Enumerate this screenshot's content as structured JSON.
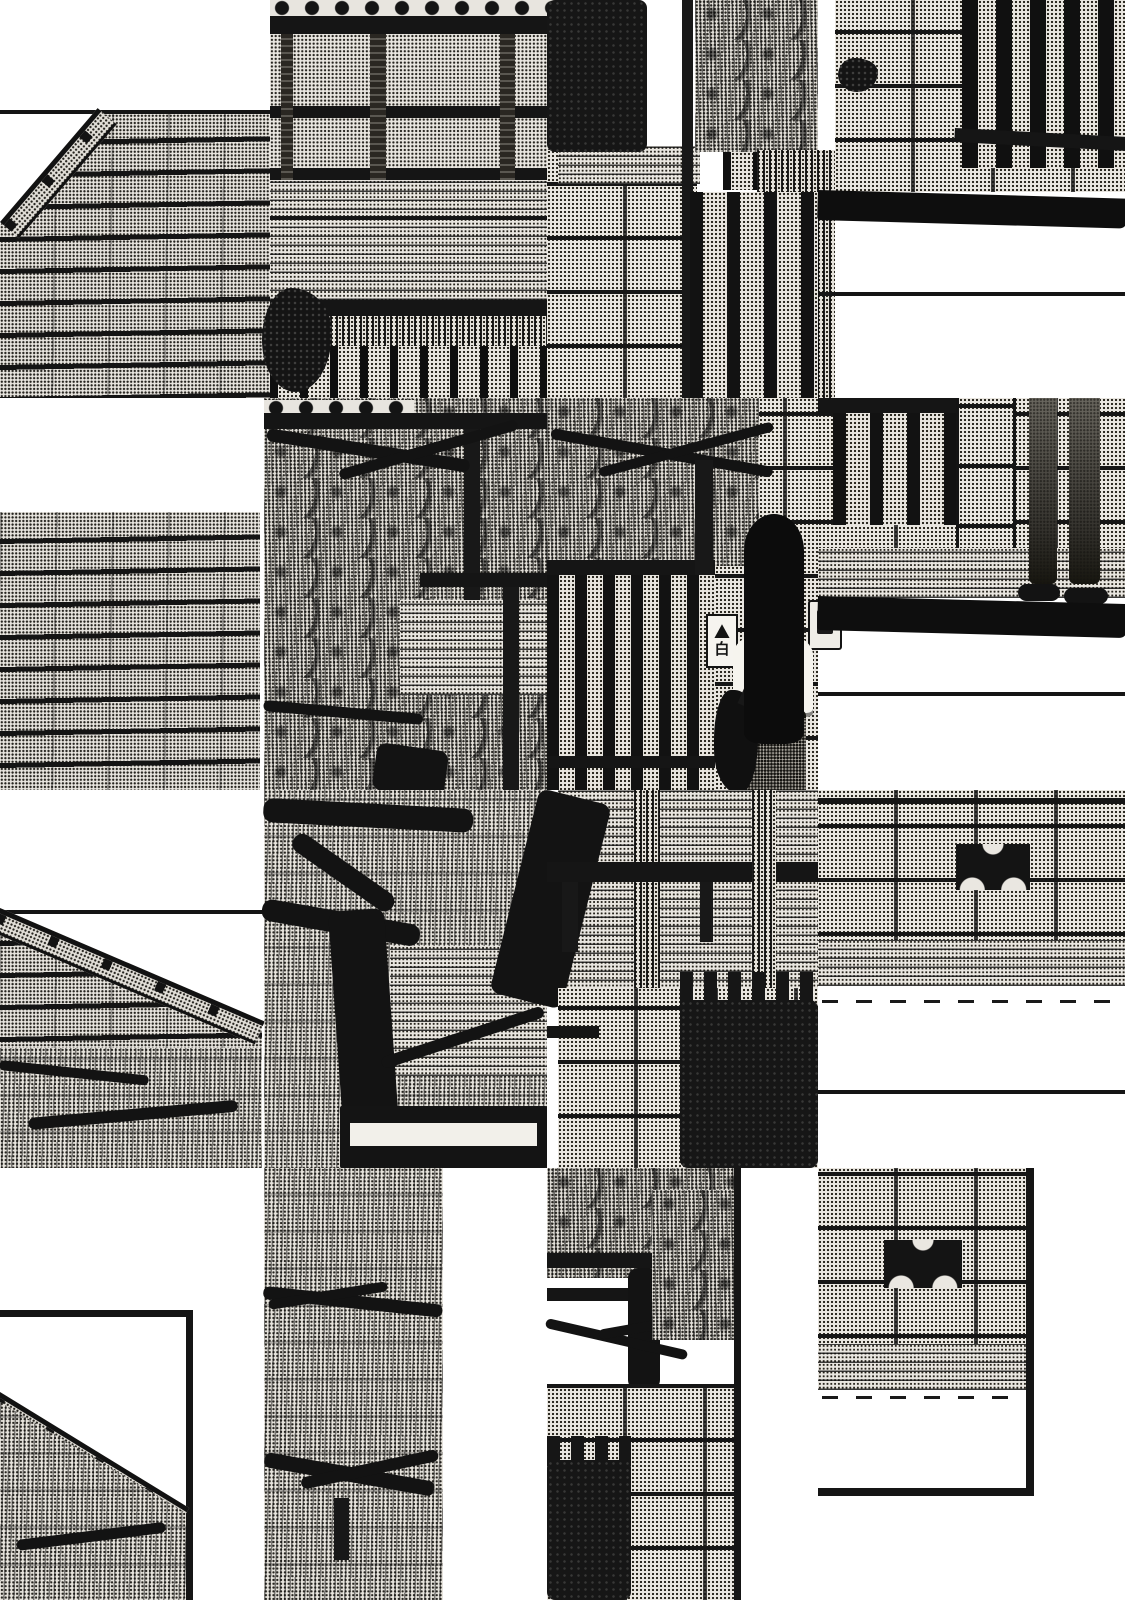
{
  "page": {
    "description": "Black-and-white manga page rendered as an offset tile collage: traditional Japanese house with wavy roof tiles, pine trees, stone walls, slatted gates, a long-haired girl in a striped shirt facing a gate nameplate, and a pedestrian's legs on the street.",
    "palette": {
      "paper": "#ffffff",
      "ink": "#141414",
      "tone": "#e8e5df"
    }
  },
  "nameplate": {
    "text": "白"
  },
  "tiles": [
    {
      "name": "panel-top-edge-line",
      "type": "line",
      "x": 0,
      "y": 110,
      "w": 390,
      "h": 4
    },
    {
      "name": "roof-tiles-top-left",
      "type": "rooftiles",
      "x": 0,
      "y": 114,
      "w": 270,
      "h": 284,
      "cls": "clip-a"
    },
    {
      "name": "roof-ridge-top-left",
      "type": "ridge",
      "x": 0,
      "y": 222,
      "w": 150,
      "h": 20,
      "rot": -49.4
    },
    {
      "name": "wood-house-wall",
      "type": "tone",
      "x": 270,
      "y": 0,
      "w": 290,
      "h": 398
    },
    {
      "name": "eave-tile-ends-row",
      "type": "circlerow",
      "x": 270,
      "y": 0,
      "w": 290,
      "h": 16
    },
    {
      "name": "eave-beam",
      "type": "line",
      "x": 270,
      "y": 16,
      "w": 290,
      "h": 18
    },
    {
      "name": "wall-beam-1",
      "type": "line",
      "x": 270,
      "y": 106,
      "w": 290,
      "h": 12
    },
    {
      "name": "wall-beam-2",
      "type": "line",
      "x": 270,
      "y": 168,
      "w": 290,
      "h": 12
    },
    {
      "name": "wall-post-1",
      "type": "woodpost",
      "x": 281,
      "y": 34,
      "w": 12,
      "h": 146
    },
    {
      "name": "wall-post-2",
      "type": "woodpost",
      "x": 370,
      "y": 34,
      "w": 16,
      "h": 146
    },
    {
      "name": "wall-post-3",
      "type": "woodpost",
      "x": 500,
      "y": 34,
      "w": 15,
      "h": 146
    },
    {
      "name": "veranda-planks",
      "type": "planks",
      "x": 270,
      "y": 180,
      "w": 290,
      "h": 120
    },
    {
      "name": "veranda-edge-line",
      "type": "line",
      "x": 270,
      "y": 216,
      "w": 290,
      "h": 4
    },
    {
      "name": "base-beam",
      "type": "line",
      "x": 270,
      "y": 300,
      "w": 290,
      "h": 16
    },
    {
      "name": "under-fringe",
      "type": "fringe",
      "x": 270,
      "y": 316,
      "w": 290,
      "h": 30
    },
    {
      "name": "lattice-fence",
      "type": "slats",
      "x": 270,
      "y": 346,
      "w": 290,
      "h": 52
    },
    {
      "name": "garden-shrub",
      "type": "pineclump",
      "x": 262,
      "y": 288,
      "w": 70,
      "h": 104
    },
    {
      "name": "stone-gate-wall",
      "type": "stonewall",
      "x": 547,
      "y": 150,
      "w": 150,
      "h": 248
    },
    {
      "name": "stone-lintel",
      "type": "planks",
      "x": 558,
      "y": 146,
      "w": 142,
      "h": 38
    },
    {
      "name": "dark-hedge-top",
      "type": "darkbush",
      "x": 547,
      "y": 0,
      "w": 100,
      "h": 152
    },
    {
      "name": "gate-post-dark",
      "type": "darkpost",
      "x": 682,
      "y": 0,
      "w": 11,
      "h": 398
    },
    {
      "name": "slatted-door",
      "type": "slats",
      "x": 723,
      "y": 0,
      "w": 40,
      "h": 190
    },
    {
      "name": "pine-tuft-top",
      "type": "pine",
      "x": 695,
      "y": 0,
      "w": 123,
      "h": 152
    },
    {
      "name": "hanging-needles",
      "type": "fringe",
      "x": 757,
      "y": 150,
      "w": 78,
      "h": 248
    },
    {
      "name": "inner-fence-bars",
      "type": "fencebars",
      "x": 690,
      "y": 192,
      "w": 128,
      "h": 206
    },
    {
      "name": "street-wall-top-right",
      "type": "stonewall",
      "x": 835,
      "y": 0,
      "w": 290,
      "h": 192
    },
    {
      "name": "wall-ornament-dark",
      "type": "pineclump",
      "x": 838,
      "y": 58,
      "w": 40,
      "h": 34
    },
    {
      "name": "iron-gate-bars",
      "type": "fencedark",
      "x": 962,
      "y": 0,
      "w": 163,
      "h": 168
    },
    {
      "name": "iron-gate-rail",
      "type": "line",
      "x": 955,
      "y": 128,
      "w": 172,
      "h": 14,
      "rot": 3
    },
    {
      "name": "road-shadow-band",
      "type": "shadow",
      "x": 818,
      "y": 190,
      "w": 310,
      "h": 30,
      "rot": 1.6
    },
    {
      "name": "road-line-1",
      "type": "line",
      "x": 818,
      "y": 292,
      "w": 307,
      "h": 4
    },
    {
      "name": "roof-tiles-left",
      "type": "rooftiles",
      "x": 0,
      "y": 512,
      "w": 260,
      "h": 278
    },
    {
      "name": "pine-tile-base",
      "type": "pine",
      "x": 264,
      "y": 398,
      "w": 283,
      "h": 392
    },
    {
      "name": "eave-ends-row-2",
      "type": "circlerow",
      "x": 264,
      "y": 400,
      "w": 150,
      "h": 13
    },
    {
      "name": "pine-beam",
      "type": "line",
      "x": 264,
      "y": 413,
      "w": 283,
      "h": 16
    },
    {
      "name": "window-post-1",
      "type": "darkpost",
      "x": 464,
      "y": 429,
      "w": 16,
      "h": 200
    },
    {
      "name": "window-wall-patch",
      "type": "planks",
      "x": 400,
      "y": 600,
      "w": 147,
      "h": 95
    },
    {
      "name": "window-rail",
      "type": "line",
      "x": 420,
      "y": 573,
      "w": 127,
      "h": 14
    },
    {
      "name": "window-post-2",
      "type": "darkpost",
      "x": 503,
      "y": 587,
      "w": 16,
      "h": 203
    },
    {
      "name": "pine-branch-1",
      "type": "branch",
      "x": 268,
      "y": 428,
      "w": 205,
      "h": 13,
      "rot": 9
    },
    {
      "name": "pine-branch-2",
      "type": "branch",
      "x": 338,
      "y": 470,
      "w": 185,
      "h": 11,
      "rot": -16
    },
    {
      "name": "pine-branch-3",
      "type": "branch",
      "x": 264,
      "y": 700,
      "w": 160,
      "h": 11,
      "rot": 5
    },
    {
      "name": "pine-trunk-piece",
      "type": "trunk",
      "x": 378,
      "y": 742,
      "w": 72,
      "h": 48,
      "rot": 8
    },
    {
      "name": "girl-tile-wall",
      "type": "stonewall",
      "x": 547,
      "y": 398,
      "w": 271,
      "h": 392
    },
    {
      "name": "bush-over-gate",
      "type": "pine",
      "x": 547,
      "y": 398,
      "w": 212,
      "h": 168
    },
    {
      "name": "bush-branch-1",
      "type": "branch",
      "x": 552,
      "y": 428,
      "w": 225,
      "h": 11,
      "rot": 10
    },
    {
      "name": "bush-branch-2",
      "type": "branch",
      "x": 598,
      "y": 468,
      "w": 180,
      "h": 10,
      "rot": -15
    },
    {
      "name": "gate-top-rail",
      "type": "line",
      "x": 547,
      "y": 560,
      "w": 168,
      "h": 15
    },
    {
      "name": "gate-hinge-post",
      "type": "darkpost",
      "x": 695,
      "y": 460,
      "w": 18,
      "h": 116
    },
    {
      "name": "garden-gate-bars",
      "type": "fencebars2",
      "x": 547,
      "y": 575,
      "w": 168,
      "h": 215
    },
    {
      "name": "gate-bottom-rail",
      "type": "line",
      "x": 547,
      "y": 756,
      "w": 168,
      "h": 12
    },
    {
      "name": "nameplate-sign",
      "type": "sign",
      "x": 706,
      "y": 614,
      "w": 28,
      "h": 50,
      "text": "白"
    },
    {
      "name": "doorbell-intercom",
      "type": "intercom",
      "x": 808,
      "y": 600,
      "w": 30,
      "h": 46
    },
    {
      "name": "girl-shirt",
      "type": "shirt",
      "x": 733,
      "y": 633,
      "w": 80,
      "h": 84
    },
    {
      "name": "girl-shorts",
      "type": "shorts",
      "x": 738,
      "y": 710,
      "w": 68,
      "h": 80
    },
    {
      "name": "girl-bag",
      "type": "bag",
      "x": 714,
      "y": 690,
      "w": 44,
      "h": 104
    },
    {
      "name": "girl-bag-strap",
      "type": "darkpost",
      "x": 770,
      "y": 630,
      "w": 7,
      "h": 80,
      "rot": 24
    },
    {
      "name": "girl-hair",
      "type": "hair",
      "x": 744,
      "y": 514,
      "w": 60,
      "h": 230
    },
    {
      "name": "wall-right-mid",
      "type": "stonewall",
      "x": 818,
      "y": 398,
      "w": 307,
      "h": 176
    },
    {
      "name": "gate2-top-rail",
      "type": "line",
      "x": 818,
      "y": 398,
      "w": 145,
      "h": 15
    },
    {
      "name": "gate2-bars",
      "type": "fencebars",
      "x": 833,
      "y": 413,
      "w": 130,
      "h": 112
    },
    {
      "name": "stone-pillar",
      "type": "pillar",
      "x": 956,
      "y": 398,
      "w": 54,
      "h": 186
    },
    {
      "name": "curb-band",
      "type": "planks",
      "x": 818,
      "y": 548,
      "w": 307,
      "h": 50
    },
    {
      "name": "walker-legs",
      "type": "legs",
      "x": 1026,
      "y": 398,
      "w": 76,
      "h": 200
    },
    {
      "name": "walker-shoe-left",
      "type": "trunk",
      "x": 1018,
      "y": 584,
      "w": 42,
      "h": 17
    },
    {
      "name": "walker-shoe-right",
      "type": "trunk",
      "x": 1064,
      "y": 588,
      "w": 44,
      "h": 16
    },
    {
      "name": "wall-shadow-band",
      "type": "shadow",
      "x": 818,
      "y": 596,
      "w": 310,
      "h": 34,
      "rot": 1.5
    },
    {
      "name": "road-line-2",
      "type": "line",
      "x": 818,
      "y": 692,
      "w": 307,
      "h": 4
    },
    {
      "name": "ridge-line-row2",
      "type": "line",
      "x": 0,
      "y": 910,
      "w": 262,
      "h": 4
    },
    {
      "name": "roof-tiles-row2",
      "type": "rooftiles",
      "x": 0,
      "y": 914,
      "w": 262,
      "h": 150,
      "cls": "clip-b"
    },
    {
      "name": "roof-ridge-row2",
      "type": "ridge",
      "x": 0,
      "y": 908,
      "w": 288,
      "h": 20,
      "rot": 23.2
    },
    {
      "name": "grass-row2",
      "type": "grass",
      "x": 0,
      "y": 1048,
      "w": 262,
      "h": 120
    },
    {
      "name": "grass-branch-1",
      "type": "branch",
      "x": 0,
      "y": 1060,
      "w": 150,
      "h": 10,
      "rot": 6
    },
    {
      "name": "grass-branch-2",
      "type": "branch",
      "x": 28,
      "y": 1118,
      "w": 210,
      "h": 12,
      "rot": -5
    },
    {
      "name": "tree-tile-base",
      "type": "grass",
      "x": 264,
      "y": 790,
      "w": 283,
      "h": 378
    },
    {
      "name": "tree-branch-horiz",
      "type": "trunk",
      "x": 264,
      "y": 798,
      "w": 210,
      "h": 24,
      "rot": 3
    },
    {
      "name": "tree-branch-mid",
      "type": "trunk",
      "x": 264,
      "y": 898,
      "w": 160,
      "h": 22,
      "rot": 10
    },
    {
      "name": "tree-arm",
      "type": "trunk",
      "x": 300,
      "y": 830,
      "w": 120,
      "h": 20,
      "rot": 35
    },
    {
      "name": "wall-behind-tree",
      "type": "planks",
      "x": 390,
      "y": 946,
      "w": 157,
      "h": 130
    },
    {
      "name": "tree-trunk-main",
      "type": "trunk",
      "x": 328,
      "y": 912,
      "w": 56,
      "h": 256,
      "rot": -4
    },
    {
      "name": "tree-branch-low",
      "type": "branch",
      "x": 380,
      "y": 1058,
      "w": 170,
      "h": 12,
      "rot": -18
    },
    {
      "name": "window-frame",
      "type": "window",
      "x": 340,
      "y": 1106,
      "w": 207,
      "h": 62
    },
    {
      "name": "wood-wall-mid",
      "type": "planks",
      "x": 558,
      "y": 790,
      "w": 260,
      "h": 200
    },
    {
      "name": "trunk-diagonal",
      "type": "trunk",
      "x": 540,
      "y": 788,
      "w": 74,
      "h": 210,
      "rot": 14
    },
    {
      "name": "post-textured-1",
      "type": "fringe",
      "x": 634,
      "y": 790,
      "w": 26,
      "h": 300
    },
    {
      "name": "bench-rail",
      "type": "line",
      "x": 547,
      "y": 862,
      "w": 271,
      "h": 20
    },
    {
      "name": "rail-leg-1",
      "type": "darkpost",
      "x": 562,
      "y": 882,
      "w": 16,
      "h": 70
    },
    {
      "name": "rail-leg-2",
      "type": "darkpost",
      "x": 700,
      "y": 882,
      "w": 13,
      "h": 60
    },
    {
      "name": "post-textured-2",
      "type": "fringe",
      "x": 752,
      "y": 790,
      "w": 24,
      "h": 262
    },
    {
      "name": "stone-wall-mid",
      "type": "stonewall",
      "x": 558,
      "y": 988,
      "w": 260,
      "h": 180
    },
    {
      "name": "dark-bar-left",
      "type": "line",
      "x": 547,
      "y": 1026,
      "w": 52,
      "h": 12
    },
    {
      "name": "hedge-teeth-mid",
      "type": "teeth",
      "x": 680,
      "y": 972,
      "w": 138,
      "h": 34
    },
    {
      "name": "dark-hedge-mid",
      "type": "darkbush",
      "x": 680,
      "y": 1000,
      "w": 138,
      "h": 168
    },
    {
      "name": "wall-right-low",
      "type": "stonewall",
      "x": 818,
      "y": 790,
      "w": 307,
      "h": 196
    },
    {
      "name": "wall-top-line",
      "type": "line",
      "x": 818,
      "y": 798,
      "w": 307,
      "h": 6
    },
    {
      "name": "ornament-trio-1",
      "type": "trio",
      "x": 956,
      "y": 844,
      "w": 74,
      "h": 46
    },
    {
      "name": "curb-band-2",
      "type": "planks",
      "x": 818,
      "y": 940,
      "w": 307,
      "h": 46
    },
    {
      "name": "road-speckle-1",
      "type": "speckle",
      "x": 822,
      "y": 1000,
      "w": 298,
      "h": 3
    },
    {
      "name": "road-line-3",
      "type": "line",
      "x": 818,
      "y": 1090,
      "w": 307,
      "h": 4
    },
    {
      "name": "panel-border-top",
      "type": "line",
      "x": 0,
      "y": 1310,
      "w": 193,
      "h": 7
    },
    {
      "name": "panel-border-right",
      "type": "line",
      "x": 186,
      "y": 1310,
      "w": 7,
      "h": 290
    },
    {
      "name": "roof-ridge-row3",
      "type": "ridge",
      "x": 0,
      "y": 1392,
      "w": 222,
      "h": 22,
      "rot": 31.5
    },
    {
      "name": "grass-row3",
      "type": "grass",
      "x": 0,
      "y": 1402,
      "w": 186,
      "h": 198,
      "cls": "clip-c"
    },
    {
      "name": "grass3-branch",
      "type": "branch",
      "x": 16,
      "y": 1540,
      "w": 150,
      "h": 11,
      "rot": -7
    },
    {
      "name": "grass-column-base",
      "type": "grass",
      "x": 264,
      "y": 1168,
      "w": 179,
      "h": 432
    },
    {
      "name": "gcol-branch-1",
      "type": "branch",
      "x": 264,
      "y": 1286,
      "w": 180,
      "h": 13,
      "rot": 6
    },
    {
      "name": "gcol-branch-2",
      "type": "branch",
      "x": 268,
      "y": 1300,
      "w": 120,
      "h": 10,
      "rot": -9
    },
    {
      "name": "gcol-branch-3",
      "type": "branch",
      "x": 266,
      "y": 1452,
      "w": 172,
      "h": 15,
      "rot": 10
    },
    {
      "name": "gcol-branch-4",
      "type": "branch",
      "x": 300,
      "y": 1478,
      "w": 140,
      "h": 12,
      "rot": -12
    },
    {
      "name": "gcol-twig",
      "type": "darkpost",
      "x": 334,
      "y": 1498,
      "w": 15,
      "h": 62
    },
    {
      "name": "pine-col-base",
      "type": "pine",
      "x": 547,
      "y": 1168,
      "w": 193,
      "h": 110
    },
    {
      "name": "bench2-top",
      "type": "line",
      "x": 547,
      "y": 1253,
      "w": 118,
      "h": 15
    },
    {
      "name": "bench2-shelf",
      "type": "line",
      "x": 547,
      "y": 1288,
      "w": 112,
      "h": 13
    },
    {
      "name": "bench2-trunk",
      "type": "trunk",
      "x": 628,
      "y": 1268,
      "w": 32,
      "h": 122
    },
    {
      "name": "pine2-branch-1",
      "type": "branch",
      "x": 547,
      "y": 1318,
      "w": 145,
      "h": 10,
      "rot": 13
    },
    {
      "name": "pine2-branch-2",
      "type": "branch",
      "x": 598,
      "y": 1330,
      "w": 125,
      "h": 10,
      "rot": -10
    },
    {
      "name": "pine2-tuft",
      "type": "pine",
      "x": 652,
      "y": 1190,
      "w": 88,
      "h": 150
    },
    {
      "name": "stone-wall-bottom",
      "type": "stonewall",
      "x": 547,
      "y": 1384,
      "w": 193,
      "h": 216
    },
    {
      "name": "hedge-teeth-bottom",
      "type": "teeth",
      "x": 547,
      "y": 1436,
      "w": 84,
      "h": 30
    },
    {
      "name": "dark-hedge-bottom",
      "type": "darkbush",
      "x": 547,
      "y": 1460,
      "w": 84,
      "h": 140
    },
    {
      "name": "panel2-border-right",
      "type": "line",
      "x": 734,
      "y": 1168,
      "w": 7,
      "h": 432
    },
    {
      "name": "wall-bottom-right",
      "type": "stonewall",
      "x": 818,
      "y": 1168,
      "w": 208,
      "h": 220
    },
    {
      "name": "ornament-trio-2",
      "type": "trio",
      "x": 884,
      "y": 1240,
      "w": 78,
      "h": 48
    },
    {
      "name": "curb-band-3",
      "type": "planks",
      "x": 818,
      "y": 1344,
      "w": 208,
      "h": 46
    },
    {
      "name": "road-speckle-2",
      "type": "speckle",
      "x": 822,
      "y": 1396,
      "w": 200,
      "h": 3
    },
    {
      "name": "panel3-border-right",
      "type": "line",
      "x": 1026,
      "y": 1168,
      "w": 8,
      "h": 327
    },
    {
      "name": "panel3-border-bottom",
      "type": "line",
      "x": 818,
      "y": 1488,
      "w": 216,
      "h": 8
    }
  ]
}
